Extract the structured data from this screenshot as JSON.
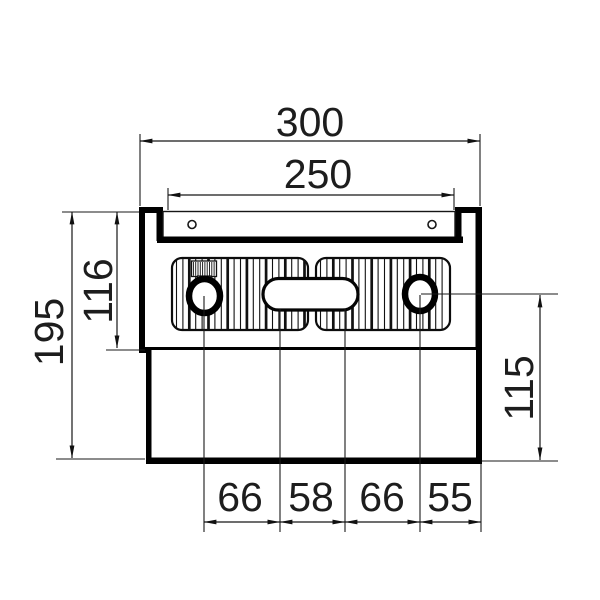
{
  "drawing": {
    "dims": {
      "top_outer": "300",
      "top_inner": "250",
      "left_total": "195",
      "left_upper": "116",
      "right_lower": "115",
      "bottom": [
        "66",
        "58",
        "66",
        "55"
      ]
    },
    "colors": {
      "line_thick": "#000000",
      "line_thin": "#1a1a1a",
      "background": "#ffffff"
    }
  }
}
